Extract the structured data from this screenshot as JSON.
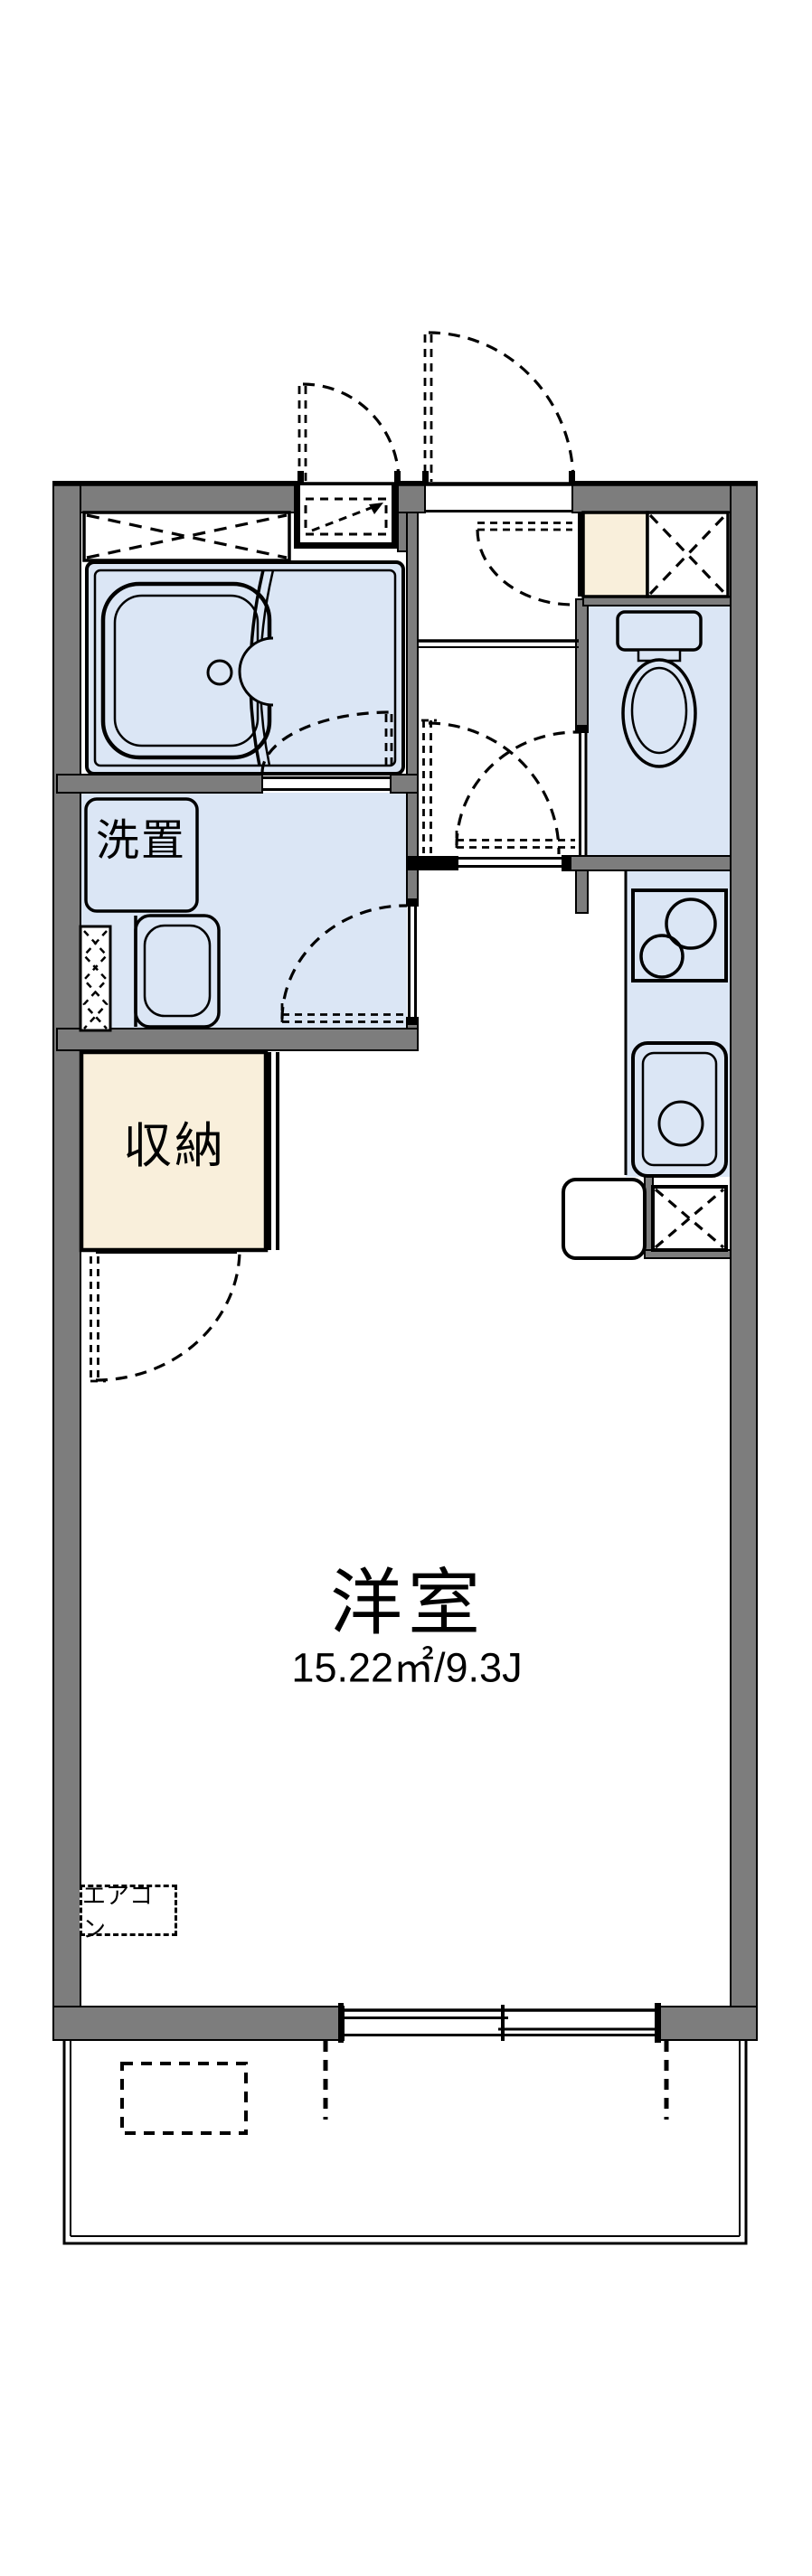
{
  "floorplan": {
    "labels": {
      "washer_area": "洗置",
      "storage": "収納",
      "main_room": "洋室",
      "main_room_area": "15.22㎡/9.3J",
      "air_conditioner": "エアコン"
    },
    "colors": {
      "wall": "#7d7d7d",
      "water_room": "#dbe6f5",
      "storage_fill": "#f9efdb",
      "line": "#000000",
      "background": "#ffffff"
    },
    "fixtures": [
      "bathtub-icon",
      "bath-door-icon",
      "washing-machine-pan-icon",
      "washbasin-icon",
      "toilet-icon",
      "stove-icon",
      "kitchen-sink-icon",
      "refrigerator-space-icon",
      "meter-box-icon",
      "shoe-cabinet-icon",
      "storage-closet",
      "air-conditioner-outdoor-unit-icon",
      "balcony",
      "sliding-window-icon"
    ]
  }
}
